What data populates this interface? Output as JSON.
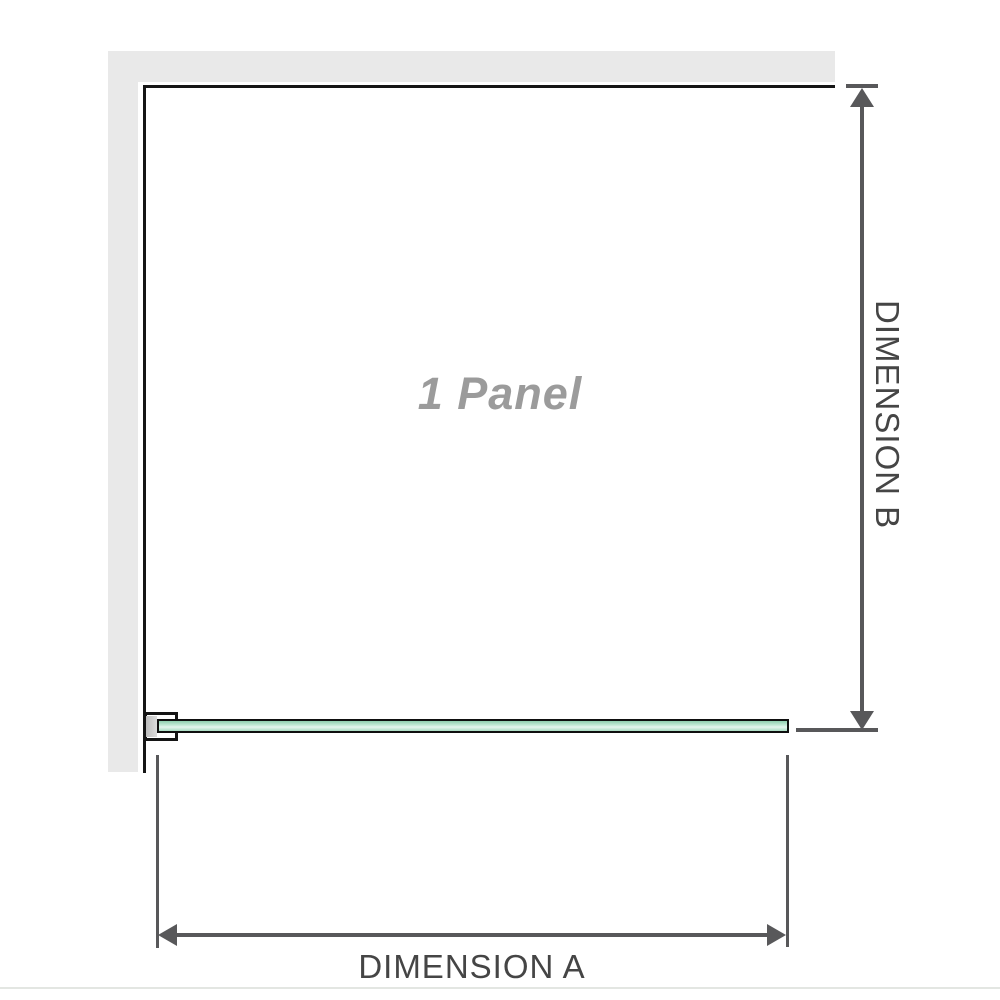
{
  "diagram": {
    "panel_label": "1 Panel",
    "dimension_a_label": "DIMENSION A",
    "dimension_b_label": "DIMENSION B"
  },
  "colors": {
    "background": "#ffffff",
    "wall_fill": "#e9e9e9",
    "outline": "#161616",
    "dimension_lines": "#58585a",
    "dimension_text": "#454545",
    "panel_text": "#9b9b9b",
    "glass_green_dark": "#8ecfae",
    "glass_green_light": "#e6f6ee",
    "glass_border": "#0f0f0f",
    "bracket_pad": "#bdbdbd",
    "baseline": "#e3e6e2"
  }
}
